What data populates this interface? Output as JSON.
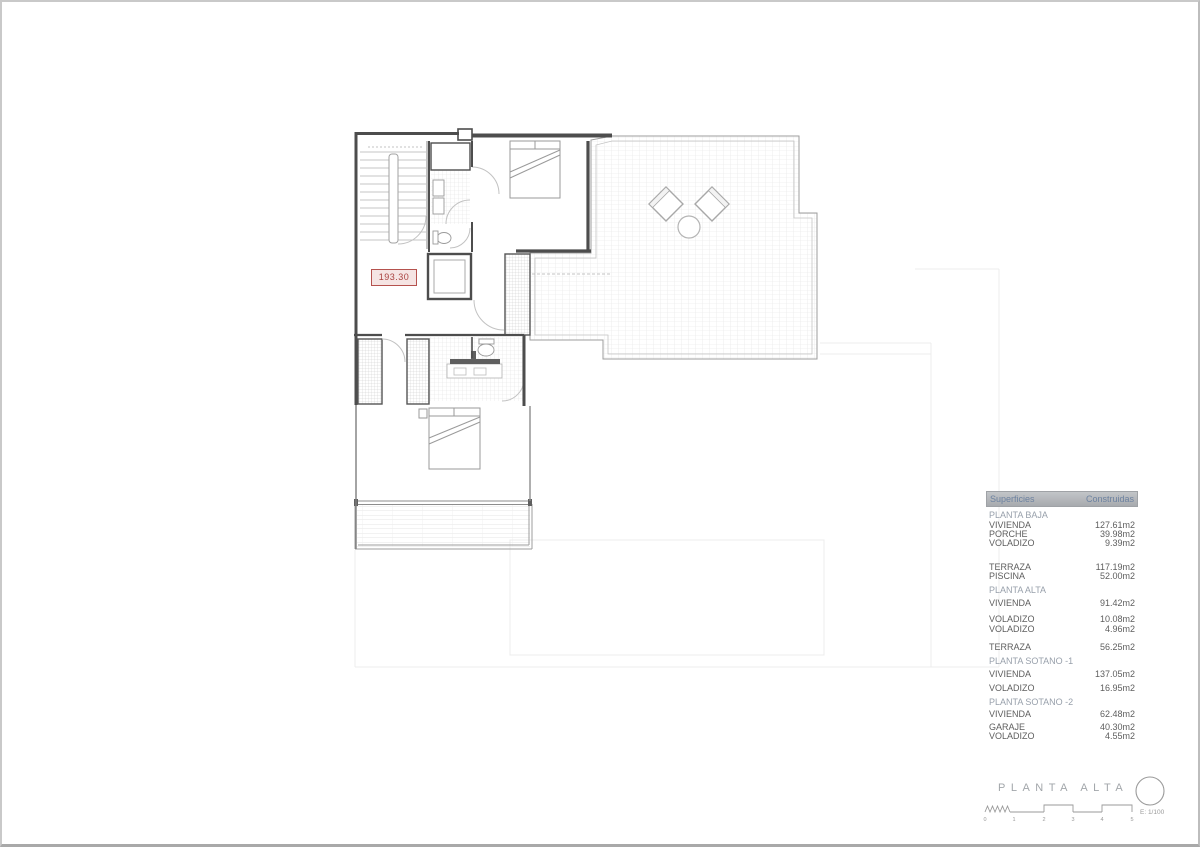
{
  "sheet": {
    "area_label": "193.30",
    "title": "PLANTA ALTA",
    "scale_label": "E: 1/100",
    "scale_ticks": [
      "0",
      "1",
      "2",
      "3",
      "4",
      "5"
    ]
  },
  "table": {
    "header": {
      "superficies": "Superficies",
      "construidas": "Construidas"
    },
    "rows": [
      {
        "kind": "section",
        "label": "PLANTA BAJA",
        "value": ""
      },
      {
        "kind": "item",
        "label": "VIVIENDA",
        "value": "127.61m2"
      },
      {
        "kind": "item",
        "label": "PORCHE",
        "value": "39.98m2"
      },
      {
        "kind": "item",
        "label": "VOLADIZO",
        "value": "9.39m2"
      },
      {
        "kind": "item",
        "label": "TERRAZA",
        "value": "117.19m2"
      },
      {
        "kind": "item",
        "label": "PISCINA",
        "value": "52.00m2"
      },
      {
        "kind": "section",
        "label": "PLANTA ALTA",
        "value": ""
      },
      {
        "kind": "item",
        "label": "VIVIENDA",
        "value": "91.42m2"
      },
      {
        "kind": "item",
        "label": "VOLADIZO",
        "value": "10.08m2"
      },
      {
        "kind": "item",
        "label": "VOLADIZO",
        "value": "4.96m2"
      },
      {
        "kind": "item",
        "label": "TERRAZA",
        "value": "56.25m2"
      },
      {
        "kind": "section",
        "label": "PLANTA SOTANO -1",
        "value": ""
      },
      {
        "kind": "item",
        "label": "VIVIENDA",
        "value": "137.05m2"
      },
      {
        "kind": "item",
        "label": "VOLADIZO",
        "value": "16.95m2"
      },
      {
        "kind": "section",
        "label": "PLANTA SOTANO -2",
        "value": ""
      },
      {
        "kind": "item",
        "label": "VIVIENDA",
        "value": "62.48m2"
      },
      {
        "kind": "item",
        "label": "GARAJE",
        "value": "40.30m2"
      },
      {
        "kind": "item",
        "label": "VOLADIZO",
        "value": "4.55m2"
      }
    ]
  },
  "colors": {
    "wall": "#4d4d4d",
    "accent_red": "#b5524e",
    "header_bg": "#b2b5b9",
    "header_text": "#6d82a0",
    "section_text": "#98a0ab",
    "row_text": "#5e5e5e"
  }
}
